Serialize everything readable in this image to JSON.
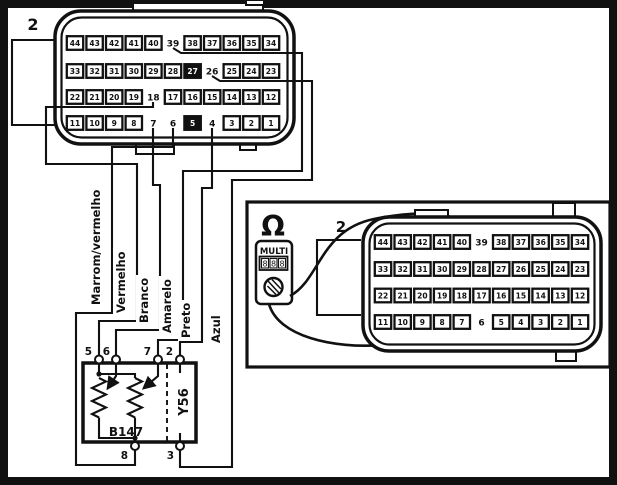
{
  "left_section": {
    "connector_label": "2",
    "connector_rows": [
      [
        44,
        43,
        42,
        41,
        40,
        39,
        38,
        37,
        36,
        35,
        34
      ],
      [
        33,
        32,
        31,
        30,
        29,
        28,
        27,
        26,
        25,
        24,
        23
      ],
      [
        22,
        21,
        20,
        19,
        18,
        17,
        16,
        15,
        14,
        13,
        12
      ],
      [
        11,
        10,
        9,
        8,
        7,
        6,
        5,
        4,
        3,
        2,
        1
      ]
    ],
    "plain_pins": [
      39,
      26,
      18,
      7,
      6,
      4
    ],
    "highlighted_pins": [
      27,
      5
    ],
    "wire_labels": [
      "Marrom/vermelho",
      "Vermelho",
      "Branco",
      "Amarelo",
      "Preto",
      "Azul"
    ],
    "component": {
      "sensor_label": "B147",
      "actuator_label": "Y56",
      "top_terminals": [
        "5",
        "6",
        "7",
        "2"
      ],
      "bottom_terminals": [
        "8",
        "3"
      ]
    }
  },
  "right_section": {
    "connector_label": "2",
    "connector_rows": [
      [
        44,
        43,
        42,
        41,
        40,
        39,
        38,
        37,
        36,
        35,
        34
      ],
      [
        33,
        32,
        31,
        30,
        29,
        28,
        27,
        26,
        25,
        24,
        23
      ],
      [
        22,
        21,
        20,
        19,
        18,
        17,
        16,
        15,
        14,
        13,
        12
      ],
      [
        11,
        10,
        9,
        8,
        7,
        6,
        5,
        4,
        3,
        2,
        1
      ]
    ],
    "plain_pins": [
      39,
      6
    ],
    "highlighted_pins": [],
    "multimeter": {
      "mode_symbol": "Ω",
      "name": "MULTI",
      "display_digits": [
        "8",
        "8",
        "8"
      ]
    }
  },
  "colors": {
    "line": "#111111",
    "background": "#ffffff"
  }
}
